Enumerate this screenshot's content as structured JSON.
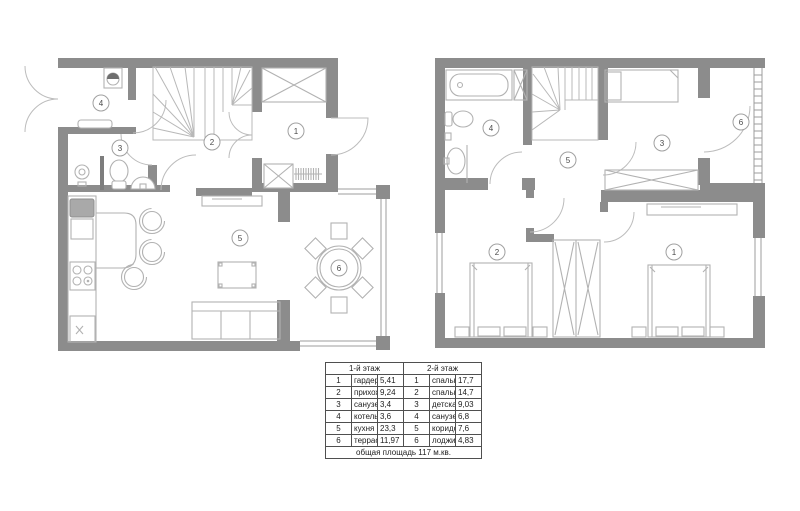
{
  "floor1": {
    "room_numbers": [
      "1",
      "2",
      "3",
      "4",
      "5",
      "6"
    ]
  },
  "floor2": {
    "room_numbers": [
      "1",
      "2",
      "3",
      "4",
      "5",
      "6"
    ]
  },
  "legend": {
    "floor1_title": "1-й этаж",
    "floor2_title": "2-й этаж",
    "floor1_rows": [
      {
        "num": "1",
        "name": "гардероб",
        "area": "5,41"
      },
      {
        "num": "2",
        "name": "прихожая",
        "area": "9,24"
      },
      {
        "num": "3",
        "name": "санузел",
        "area": "3,4"
      },
      {
        "num": "4",
        "name": "котельная",
        "area": "3,6"
      },
      {
        "num": "5",
        "name": "кухня",
        "area": "23,3"
      },
      {
        "num": "6",
        "name": "терраса",
        "area": "11,97"
      }
    ],
    "floor2_rows": [
      {
        "num": "1",
        "name": "спальня",
        "area": "17,7"
      },
      {
        "num": "2",
        "name": "спальня",
        "area": "14,7"
      },
      {
        "num": "3",
        "name": "детская",
        "area": "9,03"
      },
      {
        "num": "4",
        "name": "санузел",
        "area": "6,8"
      },
      {
        "num": "5",
        "name": "коридор",
        "area": "7,6"
      },
      {
        "num": "6",
        "name": "лоджия",
        "area": "4,83"
      }
    ],
    "footer": "общая площадь 117 м.кв."
  },
  "colors": {
    "wall": "#8c8c8c",
    "furniture_line": "#b2b2b2",
    "door_arc": "#bcbcbc",
    "text": "#1d1d1d"
  }
}
